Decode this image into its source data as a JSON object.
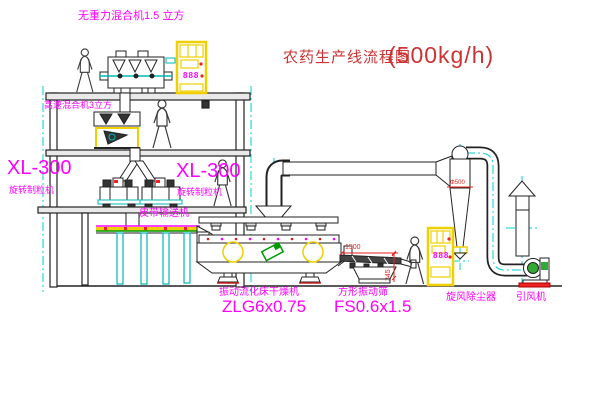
{
  "title": {
    "text": "农药生产线流程图",
    "capacity": "(500kg/h)"
  },
  "equipment": {
    "gravity_mixer": {
      "label": "无重力混合机1.5 立方"
    },
    "high_speed_mixer": {
      "label": "高速混合机3立方"
    },
    "granulator_left": {
      "model": "XL-300",
      "name": "旋转制粒机"
    },
    "granulator_right": {
      "model": "XL-300",
      "name": "旋转制粒机"
    },
    "belt_conveyor": {
      "label": "皮带输送机"
    },
    "fluid_bed_dryer": {
      "name": "振动流化床干燥机",
      "model": "ZLG6x0.75"
    },
    "vibrating_screen": {
      "name": "方形振动筛",
      "model": "FS0.6x1.5",
      "dim_width": "1500",
      "dim_height": "345"
    },
    "cyclone": {
      "label": "旋风除尘器",
      "dim": "Φ500"
    },
    "draft_fan": {
      "label": "引风机"
    },
    "control_cabinet_1": {
      "display": "888"
    },
    "control_cabinet_2": {
      "display": "888"
    }
  },
  "colors": {
    "line": "#222222",
    "cyan": "#00d0d0",
    "magenta": "#ff00ff",
    "title_red": "#cc3333",
    "dim_red": "#ee2222",
    "yellow": "#f0d000",
    "green": "#009900",
    "base_red": "#ee2222"
  }
}
